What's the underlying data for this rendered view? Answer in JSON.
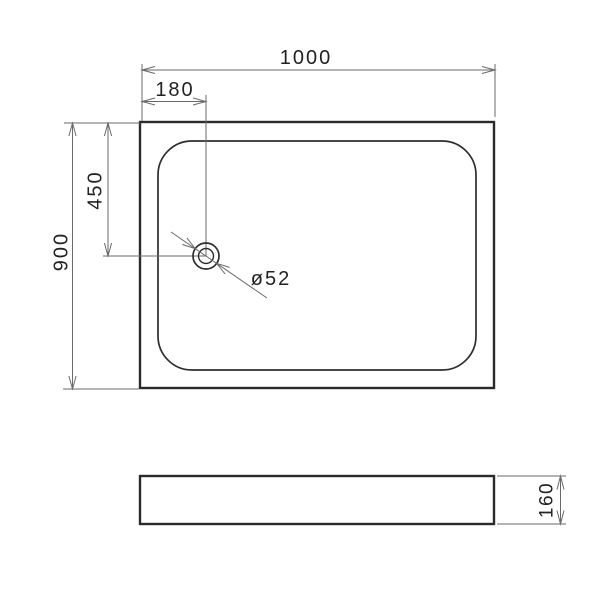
{
  "dims": {
    "width": "1000",
    "drain_offset_x": "180",
    "drain_offset_y": "450",
    "depth": "900",
    "drain_diameter": "ø52",
    "tray_height": "160"
  },
  "colors": {
    "outline": "#2b2b2b",
    "dimension_line": "#6a6a6a",
    "text": "#222222",
    "background": "#ffffff"
  }
}
